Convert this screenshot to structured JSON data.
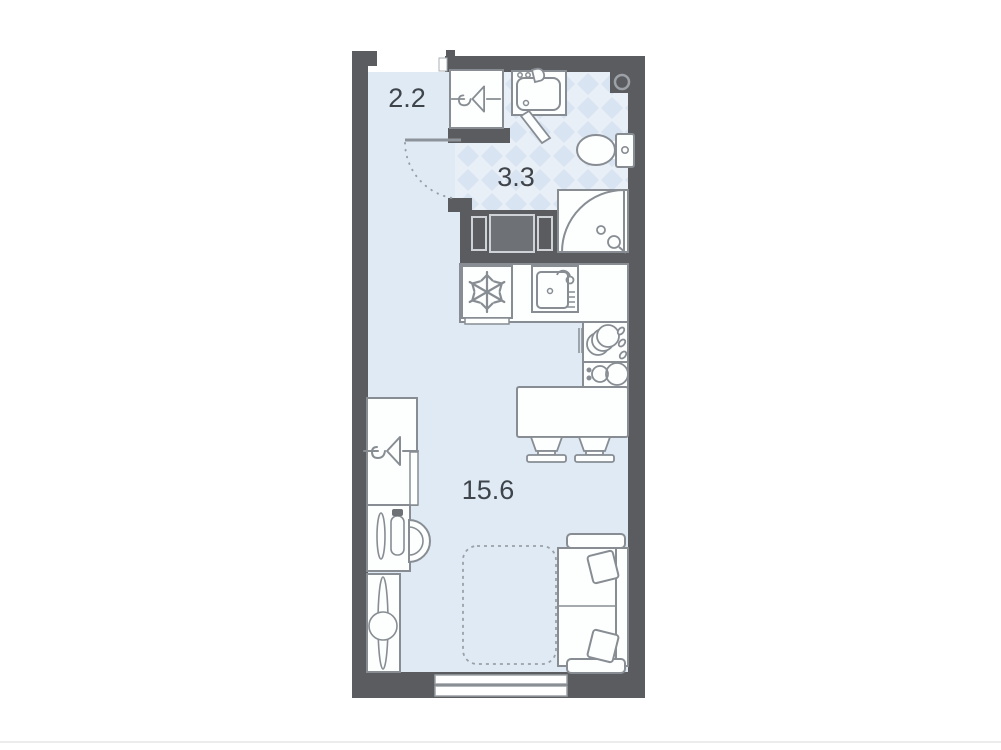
{
  "rooms": {
    "hallway": {
      "area": "2.2"
    },
    "bathroom": {
      "area": "3.3"
    },
    "living_kitchen": {
      "area": "15.6"
    }
  },
  "colors": {
    "background": "#ffffff",
    "wall": "#5b5c5f",
    "floor": "#dfeaf5",
    "tile_base": "#e9eff6",
    "tile_diamond": "#d8e4f1",
    "outline": "#878d93",
    "text": "#3f444a"
  },
  "fixtures": [
    "entrance-opening",
    "entry-wardrobe-hanger",
    "hall-bathroom-door",
    "bathroom-sink",
    "toilet",
    "shower-cabin",
    "ventilation-shaft",
    "washer-cabinet",
    "fridge-snowflake",
    "kitchen-sink",
    "dish-rack",
    "cooktop-2-burner",
    "dining-table",
    "dining-chair-left",
    "dining-chair-right",
    "living-wardrobe-hanger",
    "desk",
    "desk-chair",
    "tv-stand",
    "sofa-bed",
    "fold-out-bed-outline",
    "window"
  ]
}
